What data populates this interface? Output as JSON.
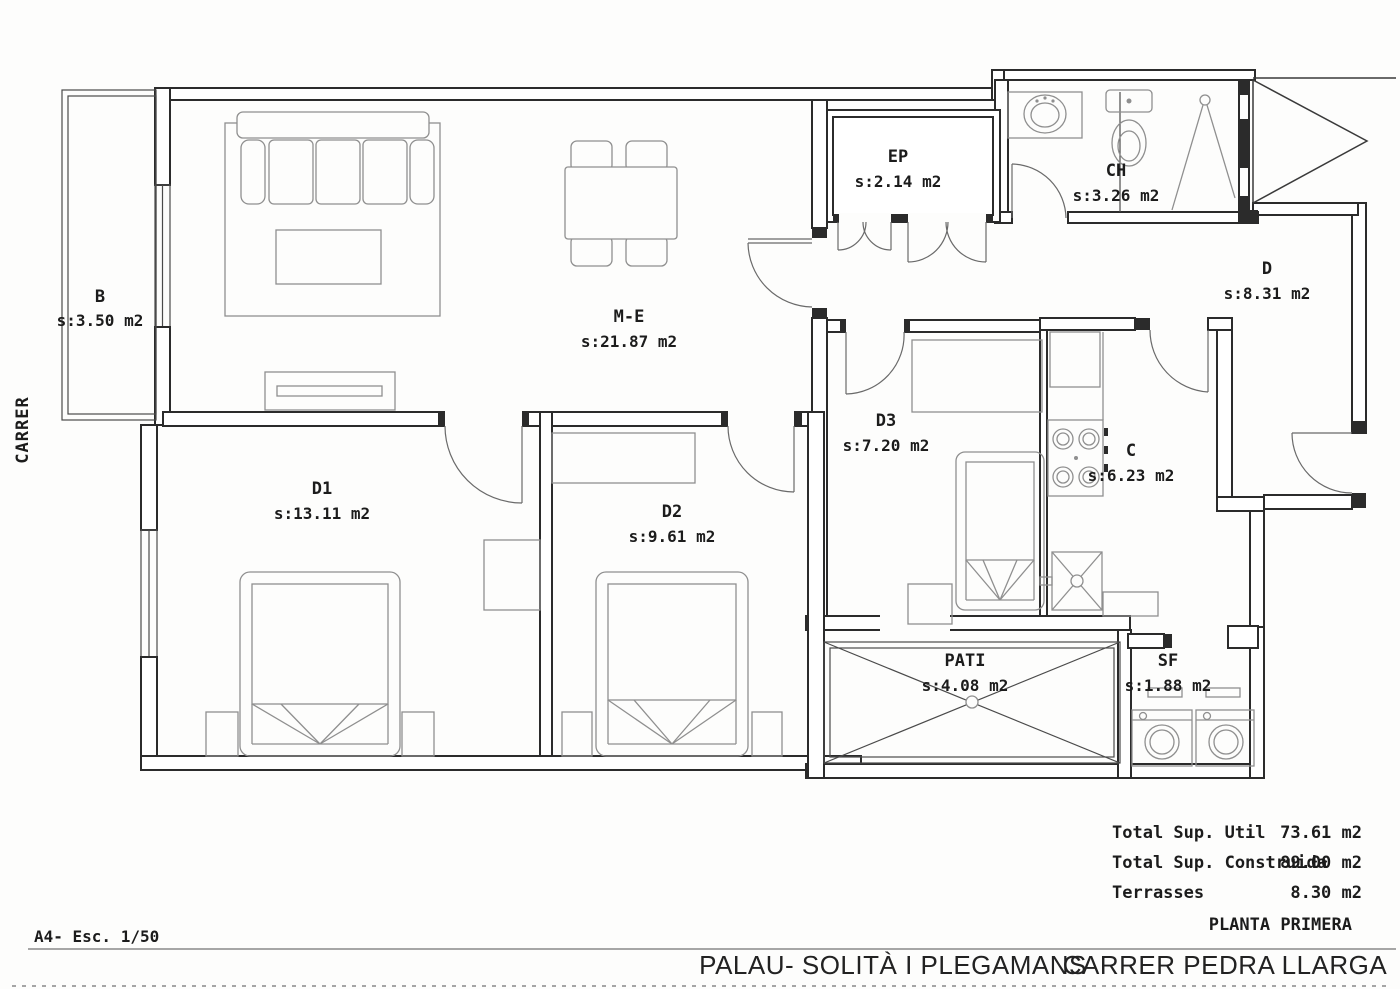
{
  "street_label": "CARRER",
  "rooms": {
    "b": {
      "code": "B",
      "area": "s:3.50 m2"
    },
    "me": {
      "code": "M-E",
      "area": "s:21.87 m2"
    },
    "ep": {
      "code": "EP",
      "area": "s:2.14 m2"
    },
    "ch": {
      "code": "CH",
      "area": "s:3.26 m2"
    },
    "d": {
      "code": "D",
      "area": "s:8.31 m2"
    },
    "d1": {
      "code": "D1",
      "area": "s:13.11 m2"
    },
    "d2": {
      "code": "D2",
      "area": "s:9.61 m2"
    },
    "d3": {
      "code": "D3",
      "area": "s:7.20 m2"
    },
    "c": {
      "code": "C",
      "area": "s:6.23 m2"
    },
    "pati": {
      "code": "PATI",
      "area": "s:4.08 m2"
    },
    "sf": {
      "code": "SF",
      "area": "s:1.88 m2"
    }
  },
  "summary": {
    "rows": [
      {
        "label": "Total Sup. Util",
        "value": "73.61 m2"
      },
      {
        "label": "Total Sup. Construida",
        "value": "89.00 m2"
      },
      {
        "label": "Terrasses",
        "value": "8.30 m2"
      }
    ],
    "plan_name": "PLANTA PRIMERA"
  },
  "footer": {
    "sheet_scale": "A4-  Esc. 1/50",
    "municipality": "PALAU- SOLITÀ I PLEGAMANS",
    "street": "CARRER PEDRA LLARGA"
  }
}
